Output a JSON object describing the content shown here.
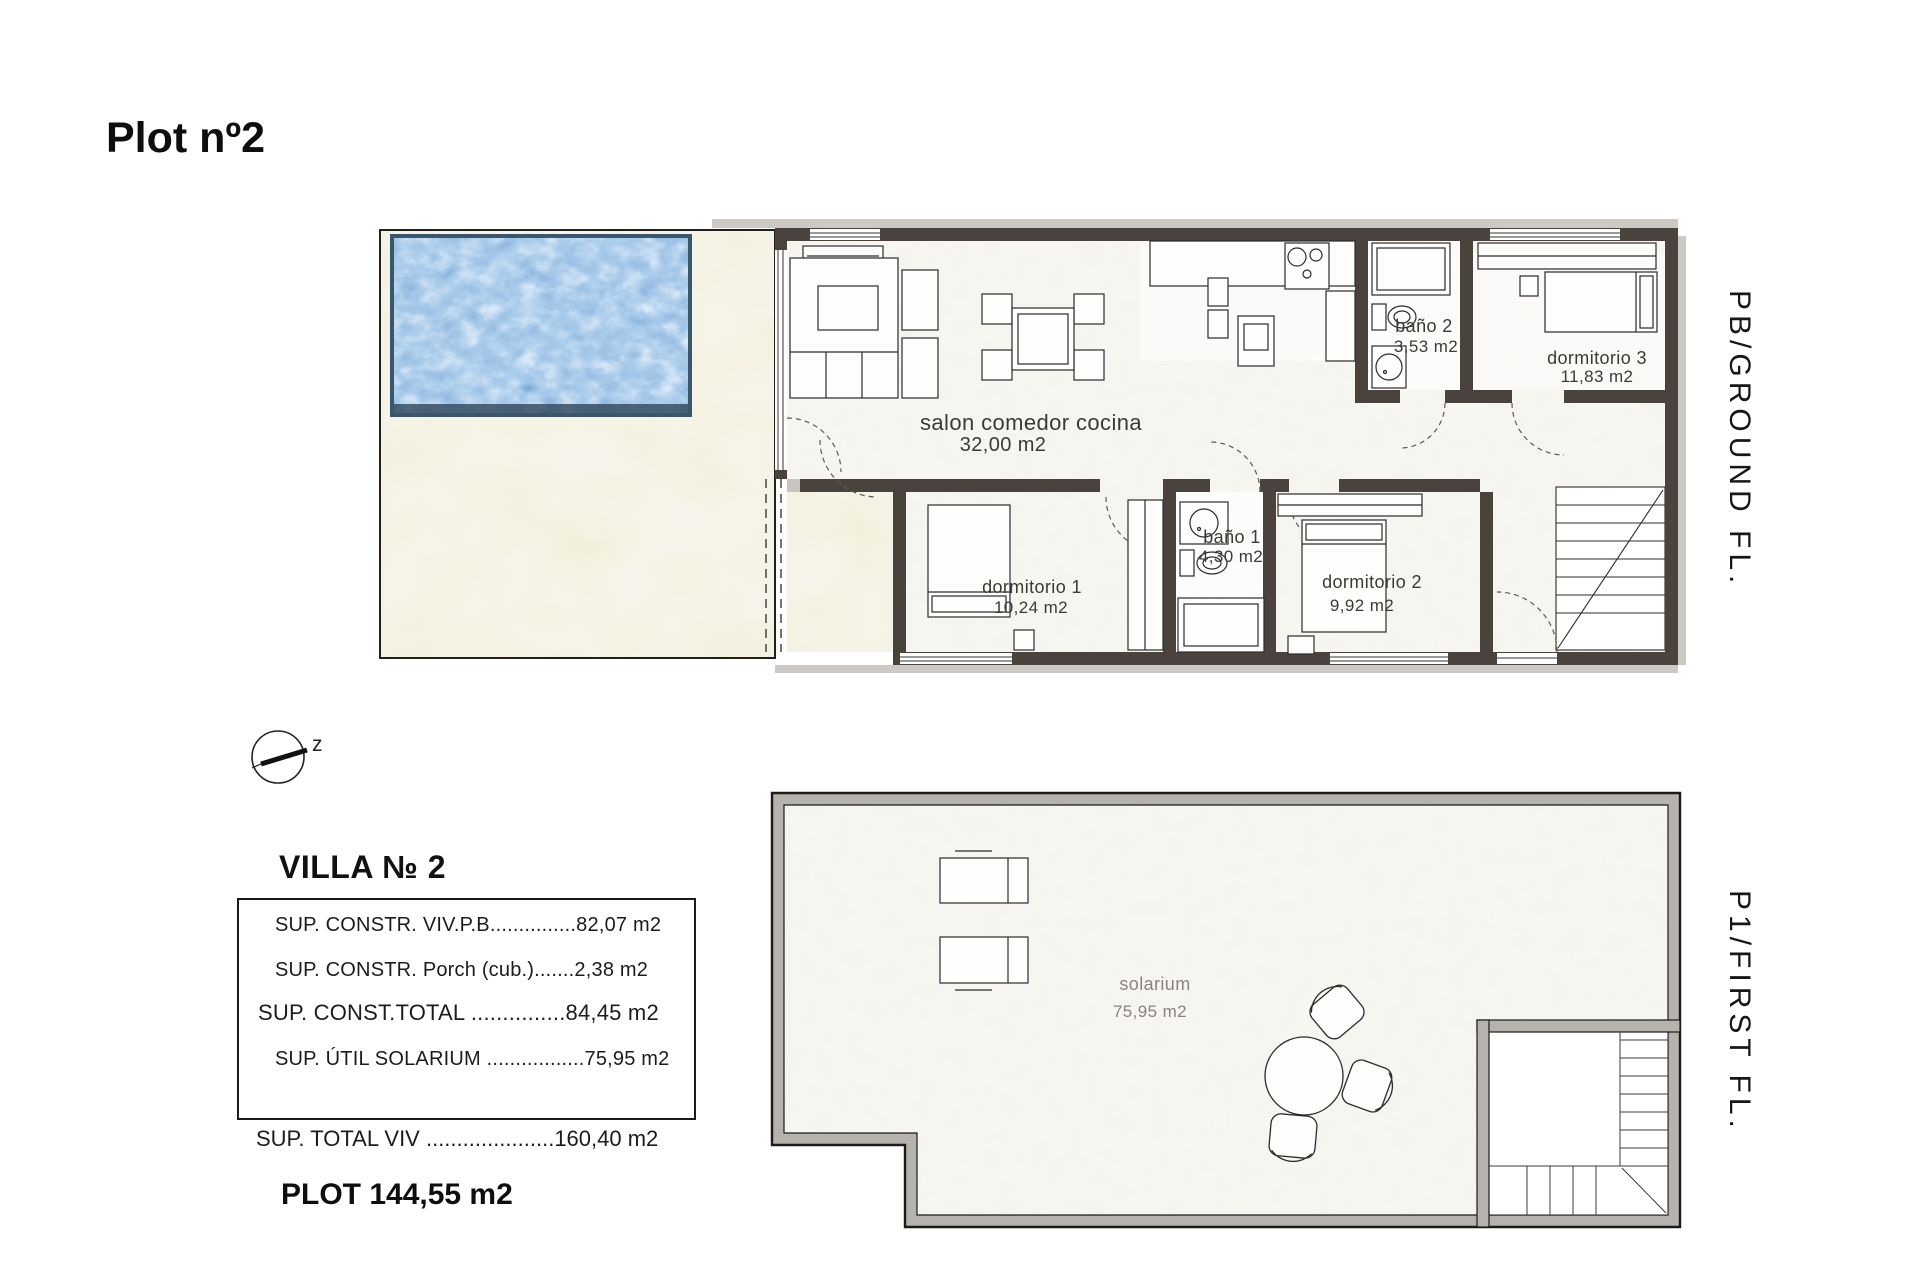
{
  "page_title": "Plot nº2",
  "ground_floor": {
    "side_label": "PB/GROUND FL.",
    "rooms": [
      {
        "name": "salon comedor cocina",
        "area": "32,00 m2"
      },
      {
        "name": "baño 2",
        "area": "3,53 m2"
      },
      {
        "name": "dormitorio 3",
        "area": "11,83 m2"
      },
      {
        "name": "dormitorio 1",
        "area": "10,24 m2"
      },
      {
        "name": "baño 1",
        "area": "4,30 m2"
      },
      {
        "name": "dormitorio 2",
        "area": "9,92 m2"
      }
    ]
  },
  "first_floor": {
    "side_label": "P1/FIRST FL.",
    "rooms": [
      {
        "name": "solarium",
        "area": "75,95 m2"
      }
    ]
  },
  "compass": {
    "label": "z"
  },
  "summary": {
    "heading": "VILLA № 2",
    "box_rows": [
      "SUP. CONSTR. VIV.P.B...............82,07 m2",
      "SUP. CONSTR. Porch (cub.).......2,38 m2",
      "SUP. CONST.TOTAL ...............84,45 m2",
      "SUP. ÚTIL SOLARIUM .................75,95 m2"
    ],
    "total_row": "SUP. TOTAL VIV .....................160,40 m2",
    "plot_row": "PLOT 144,55 m2"
  },
  "colors": {
    "wall": "#4a423c",
    "first_floor_wall_band": "#b6b2ad",
    "pool_deep": "#2f465a",
    "terrace": "#e9e5d2",
    "floor": "#f2f0e9",
    "shadow": "#cdcac5"
  }
}
